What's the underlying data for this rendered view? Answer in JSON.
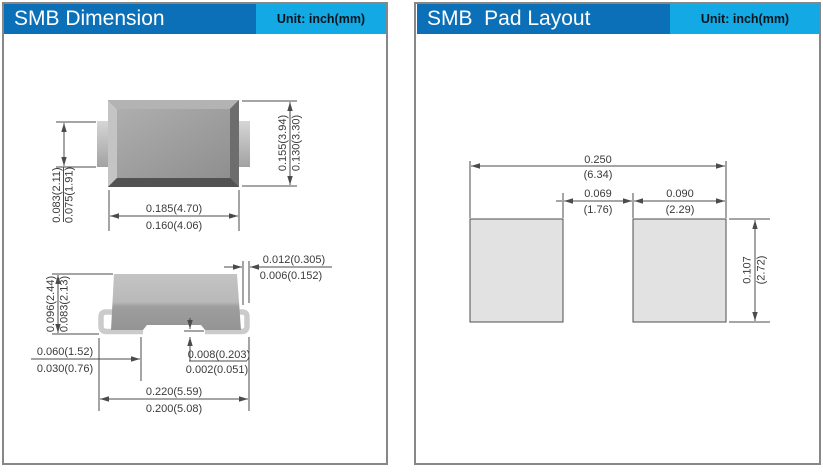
{
  "dimension_panel": {
    "title": "SMB Dimension",
    "unit_label": "Unit: inch(mm)",
    "top_view": {
      "lead_width": {
        "max": "0.083(2.11)",
        "min": "0.075(1.91)"
      },
      "body_height": {
        "max": "0.155(3.94)",
        "min": "0.130(3.30)"
      },
      "body_width": {
        "max": "0.185(4.70)",
        "min": "0.160(4.06)"
      }
    },
    "side_view": {
      "overall_height": {
        "max": "0.096(2.44)",
        "min": "0.083(2.13)"
      },
      "lead_thickness": {
        "max": "0.012(0.305)",
        "min": "0.006(0.152)"
      },
      "lead_length": {
        "max": "0.060(1.52)",
        "min": "0.030(0.76)"
      },
      "standoff": {
        "max": "0.008(0.203)",
        "min": "0.002(0.051)"
      },
      "overall_length": {
        "max": "0.220(5.59)",
        "min": "0.200(5.08)"
      }
    }
  },
  "pad_layout_panel": {
    "title": "SMB  Pad Layout",
    "unit_label": "Unit: inch(mm)",
    "dims": {
      "overall_width": {
        "value": "0.250",
        "mm": "(6.34)"
      },
      "gap": {
        "value": "0.069",
        "mm": "(1.76)"
      },
      "pad_width": {
        "value": "0.090",
        "mm": "(2.29)"
      },
      "pad_height": {
        "value": "0.107",
        "mm": "(2.72)"
      }
    }
  },
  "colors": {
    "header_dark_blue": "#0b70b7",
    "header_light_blue": "#12a9e4",
    "panel_border_gray": "#878787",
    "dimension_line": "#4b4b4b",
    "pad_fill": "#e2e2e2",
    "body_gray": "#9e9e9e",
    "lead_gray": "#cbcbcb"
  }
}
